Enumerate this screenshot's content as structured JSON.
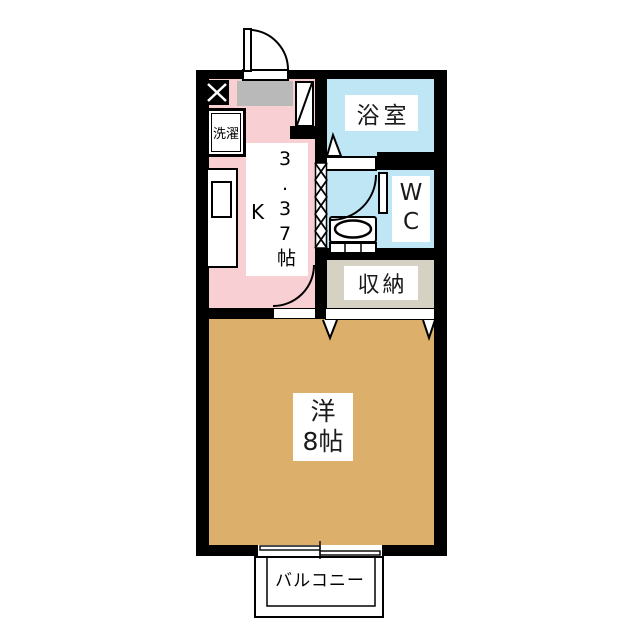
{
  "plan_title": "1K apartment floor plan",
  "rooms": {
    "bathroom": {
      "label": "浴室"
    },
    "wc": {
      "label": "WC"
    },
    "closet": {
      "label": "収納"
    },
    "kitchen": {
      "type_label": "K",
      "size_label": "3.37帖"
    },
    "western_room": {
      "name_label": "洋",
      "size_label": "8帖"
    },
    "balcony": {
      "label": "バルコニー"
    },
    "laundry": {
      "label": "洗濯"
    }
  },
  "colors": {
    "wall": "#000000",
    "kitchen": "#f8cfd3",
    "water_rooms": "#bfe6f4",
    "closet": "#d5d1c3",
    "western_room": "#dcb06a",
    "entrance_mat": "#b9b9b9",
    "background": "#ffffff"
  }
}
